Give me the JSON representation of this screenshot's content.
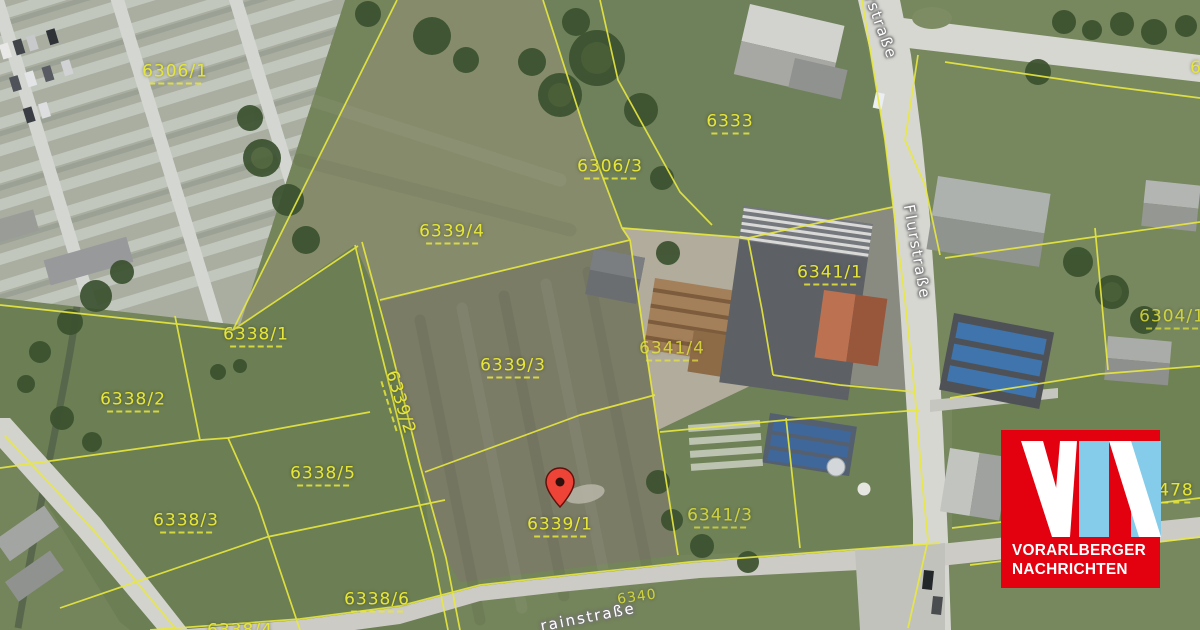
{
  "map": {
    "parcel_labels": [
      {
        "text": "6306/1"
      },
      {
        "text": "6333"
      },
      {
        "text": "6306/3"
      },
      {
        "text": "6339/4"
      },
      {
        "text": "6338/1"
      },
      {
        "text": "6338/2"
      },
      {
        "text": "6339/2"
      },
      {
        "text": "6339/3"
      },
      {
        "text": "6341/1"
      },
      {
        "text": "6341/4"
      },
      {
        "text": "6341/3"
      },
      {
        "text": "6304/1"
      },
      {
        "text": "6338/5"
      },
      {
        "text": "6338/3"
      },
      {
        "text": "6339/1"
      },
      {
        "text": "6338/6"
      },
      {
        "text": "6338/4"
      },
      {
        "text": "478"
      },
      {
        "text": "6340"
      },
      {
        "text": "6"
      }
    ],
    "street_labels": [
      {
        "text": "Flurstraße"
      },
      {
        "text": "rstraße"
      },
      {
        "text": "rainstraße"
      }
    ],
    "marker": {
      "type": "location-pin",
      "color": "#ee4437"
    }
  },
  "logo": {
    "monogram": "VN",
    "line1": "VORARLBERGER",
    "line2": "NACHRICHTEN",
    "bg_color": "#e3000f",
    "n_color": "#85cbea"
  },
  "colors": {
    "parcel_line": "#e9e93f",
    "parcel_label": "#e6e63a",
    "road": "#d7d7d2",
    "field_green": "#74845b",
    "field_brown": "#7b7c66"
  }
}
